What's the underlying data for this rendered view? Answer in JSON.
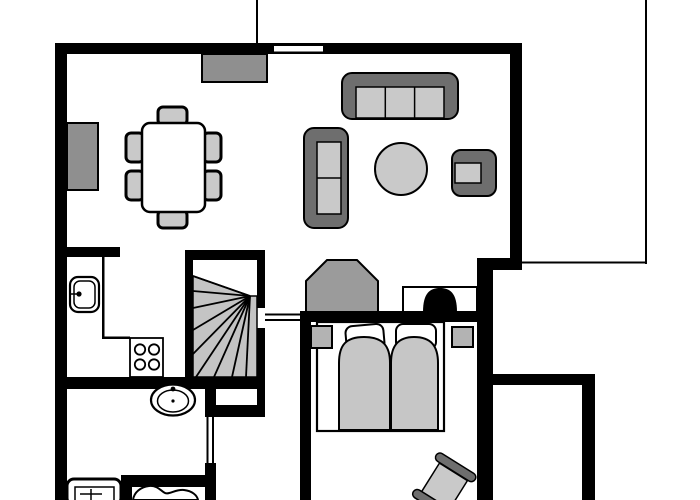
{
  "canvas": {
    "w": 700,
    "h": 500,
    "bg": "#ffffff"
  },
  "palette": {
    "ink": "#000000",
    "dark": "#6e6e6e",
    "mid": "#8f8f8f",
    "gray9b": "#9b9b9b",
    "light": "#c9c9c9",
    "bedgray": "#c6c6c6",
    "stair": "#c4c4c4",
    "nstand": "#b3b3b3",
    "white": "#ffffff"
  },
  "walls": [
    {
      "x": 55,
      "y": 43,
      "w": 467,
      "h": 11
    },
    {
      "x": 55,
      "y": 43,
      "w": 12,
      "h": 457
    },
    {
      "x": 510,
      "y": 43,
      "w": 12,
      "h": 222
    },
    {
      "x": 477,
      "y": 258,
      "w": 45,
      "h": 12
    },
    {
      "x": 477,
      "y": 258,
      "w": 16,
      "h": 242
    },
    {
      "x": 300,
      "y": 311,
      "w": 177,
      "h": 11
    },
    {
      "x": 300,
      "y": 311,
      "w": 11,
      "h": 189
    },
    {
      "x": 55,
      "y": 247,
      "w": 65,
      "h": 10
    },
    {
      "x": 185,
      "y": 250,
      "w": 80,
      "h": 10
    },
    {
      "x": 185,
      "y": 250,
      "w": 8,
      "h": 139
    },
    {
      "x": 257,
      "y": 250,
      "w": 8,
      "h": 58
    },
    {
      "x": 257,
      "y": 328,
      "w": 8,
      "h": 61
    },
    {
      "x": 55,
      "y": 377,
      "w": 210,
      "h": 12
    },
    {
      "x": 257,
      "y": 389,
      "w": 8,
      "h": 28
    },
    {
      "x": 205,
      "y": 405,
      "w": 60,
      "h": 12
    },
    {
      "x": 205,
      "y": 389,
      "w": 11,
      "h": 28
    },
    {
      "x": 205,
      "y": 463,
      "w": 11,
      "h": 37
    },
    {
      "x": 121,
      "y": 475,
      "w": 95,
      "h": 12
    },
    {
      "x": 121,
      "y": 475,
      "w": 11,
      "h": 25
    },
    {
      "x": 493,
      "y": 374,
      "w": 102,
      "h": 11
    },
    {
      "x": 582,
      "y": 374,
      "w": 13,
      "h": 126
    }
  ],
  "thin_lines": [
    {
      "x": 256,
      "y": 0,
      "w": 2,
      "h": 44
    },
    {
      "x": 645,
      "y": 0,
      "w": 2,
      "h": 264
    },
    {
      "x": 522,
      "y": 261.5,
      "w": 123,
      "h": 2
    },
    {
      "x": 102,
      "y": 257,
      "w": 2.5,
      "h": 81
    },
    {
      "x": 102,
      "y": 336.5,
      "w": 28,
      "h": 2.5
    }
  ],
  "openings": [
    {
      "name": "window-living-top",
      "rect": {
        "x": 274,
        "y": 46,
        "w": 49,
        "h": 5.5
      },
      "lines": []
    },
    {
      "name": "doorway-hall",
      "rect": {
        "x": 265,
        "y": 308,
        "w": 35,
        "h": 20
      },
      "lines": [
        {
          "x": 265,
          "y": 313.5,
          "w": 35,
          "h": 2
        },
        {
          "x": 265,
          "y": 319,
          "w": 35,
          "h": 2
        }
      ]
    },
    {
      "name": "doorway-bathroom",
      "rect": {
        "x": 205,
        "y": 417,
        "w": 11,
        "h": 46
      },
      "lines": [
        {
          "x": 206.5,
          "y": 417,
          "w": 2,
          "h": 46
        },
        {
          "x": 212,
          "y": 417,
          "w": 2,
          "h": 46
        }
      ]
    }
  ],
  "furniture": [
    {
      "name": "stairs",
      "shapes": [
        {
          "k": "poly",
          "pts": "193,276 250,296 257,296 257,377 193,377",
          "f": "stair",
          "s": "ink",
          "sw": 1.5
        },
        {
          "k": "line",
          "x1": 250,
          "y1": 296,
          "x2": 193,
          "y2": 276,
          "sw": 1.8
        },
        {
          "k": "line",
          "x1": 250,
          "y1": 296,
          "x2": 193,
          "y2": 291,
          "sw": 1.8
        },
        {
          "k": "line",
          "x1": 250,
          "y1": 296,
          "x2": 193,
          "y2": 308,
          "sw": 1.8
        },
        {
          "k": "line",
          "x1": 250,
          "y1": 296,
          "x2": 193,
          "y2": 330,
          "sw": 1.8
        },
        {
          "k": "line",
          "x1": 250,
          "y1": 296,
          "x2": 193,
          "y2": 354,
          "sw": 1.8
        },
        {
          "k": "line",
          "x1": 250,
          "y1": 296,
          "x2": 196,
          "y2": 377,
          "sw": 1.8
        },
        {
          "k": "line",
          "x1": 250,
          "y1": 296,
          "x2": 214,
          "y2": 377,
          "sw": 1.8
        },
        {
          "k": "line",
          "x1": 250,
          "y1": 296,
          "x2": 232,
          "y2": 377,
          "sw": 1.8
        },
        {
          "k": "line",
          "x1": 250,
          "y1": 296,
          "x2": 246,
          "y2": 377,
          "sw": 1.8
        }
      ]
    },
    {
      "name": "top-sideboard",
      "shapes": [
        {
          "k": "rect",
          "x": 202,
          "y": 54,
          "w": 65,
          "h": 28,
          "f": "mid",
          "s": "ink",
          "sw": 2
        }
      ]
    },
    {
      "name": "left-sideboard",
      "shapes": [
        {
          "k": "rect",
          "x": 67,
          "y": 123,
          "w": 31,
          "h": 67,
          "f": "mid",
          "s": "ink",
          "sw": 2
        }
      ]
    },
    {
      "name": "dining-set",
      "shapes": [
        {
          "k": "rect",
          "x": 158,
          "y": 107,
          "w": 29,
          "h": 18,
          "rx": 5,
          "f": "light",
          "s": "ink",
          "sw": 3
        },
        {
          "k": "rect",
          "x": 158,
          "y": 210,
          "w": 29,
          "h": 18,
          "rx": 5,
          "f": "light",
          "s": "ink",
          "sw": 3
        },
        {
          "k": "rect",
          "x": 126,
          "y": 133,
          "w": 18,
          "h": 29,
          "rx": 5,
          "f": "light",
          "s": "ink",
          "sw": 3
        },
        {
          "k": "rect",
          "x": 126,
          "y": 171,
          "w": 18,
          "h": 29,
          "rx": 5,
          "f": "light",
          "s": "ink",
          "sw": 3
        },
        {
          "k": "rect",
          "x": 203,
          "y": 133,
          "w": 18,
          "h": 29,
          "rx": 5,
          "f": "light",
          "s": "ink",
          "sw": 3
        },
        {
          "k": "rect",
          "x": 203,
          "y": 171,
          "w": 18,
          "h": 29,
          "rx": 5,
          "f": "light",
          "s": "ink",
          "sw": 3
        },
        {
          "k": "rect",
          "x": 142,
          "y": 123,
          "w": 63,
          "h": 89,
          "rx": 8,
          "f": "white",
          "s": "ink",
          "sw": 2.5
        }
      ]
    },
    {
      "name": "sofa-large",
      "shapes": [
        {
          "k": "rect",
          "x": 342,
          "y": 73,
          "w": 116,
          "h": 46,
          "rx": 10,
          "f": "dark",
          "s": "ink",
          "sw": 2
        },
        {
          "k": "rect",
          "x": 356,
          "y": 87,
          "w": 88,
          "h": 31,
          "f": "light",
          "s": "ink",
          "sw": 1.5
        },
        {
          "k": "line",
          "x1": 385.3,
          "y1": 87,
          "x2": 385.3,
          "y2": 118,
          "sw": 1.5
        },
        {
          "k": "line",
          "x1": 414.6,
          "y1": 87,
          "x2": 414.6,
          "y2": 118,
          "sw": 1.5
        }
      ]
    },
    {
      "name": "sofa-small",
      "shapes": [
        {
          "k": "rect",
          "x": 304,
          "y": 128,
          "w": 44,
          "h": 100,
          "rx": 10,
          "f": "dark",
          "s": "ink",
          "sw": 2
        },
        {
          "k": "rect",
          "x": 317,
          "y": 142,
          "w": 24,
          "h": 72,
          "f": "light",
          "s": "ink",
          "sw": 1.5
        },
        {
          "k": "line",
          "x1": 317,
          "y1": 178,
          "x2": 341,
          "y2": 178,
          "sw": 1.5
        }
      ]
    },
    {
      "name": "coffee-table",
      "shapes": [
        {
          "k": "circle",
          "cx": 401,
          "cy": 169,
          "r": 26,
          "f": "light",
          "s": "ink",
          "sw": 2
        }
      ]
    },
    {
      "name": "armchair",
      "shapes": [
        {
          "k": "rect",
          "x": 452,
          "y": 150,
          "w": 44,
          "h": 46,
          "rx": 9,
          "f": "dark",
          "s": "ink",
          "sw": 2
        },
        {
          "k": "rect",
          "x": 455,
          "y": 163,
          "w": 26,
          "h": 20,
          "f": "light",
          "s": "ink",
          "sw": 1.5
        }
      ]
    },
    {
      "name": "wardrobe",
      "shapes": [
        {
          "k": "poly",
          "pts": "306,281 327,260 357,260 378,281 378,312 306,312",
          "f": "gray9b",
          "s": "ink",
          "sw": 2
        }
      ]
    },
    {
      "name": "tv-cabinet",
      "shapes": [
        {
          "k": "rect",
          "x": 403,
          "y": 287,
          "w": 74,
          "h": 25,
          "f": "white",
          "s": "ink",
          "sw": 2
        },
        {
          "k": "path",
          "d": "M423,312 C423,293 430,288 440,288 C450,288 457,293 457,312 Z",
          "f": "ink"
        }
      ]
    },
    {
      "name": "double-bed",
      "shapes": [
        {
          "k": "rect",
          "x": 317,
          "y": 322,
          "w": 127,
          "h": 109,
          "f": "white",
          "s": "ink",
          "sw": 2.2
        },
        {
          "k": "rect",
          "x": 346,
          "y": 325,
          "w": 38,
          "h": 26,
          "rx": 7,
          "f": "white",
          "s": "ink",
          "sw": 2,
          "tf": "rotate(-5 365 338)"
        },
        {
          "k": "rect",
          "x": 396,
          "y": 324,
          "w": 40,
          "h": 25,
          "rx": 7,
          "f": "white",
          "s": "ink",
          "sw": 2
        },
        {
          "k": "path",
          "d": "M339,430 L339,363 C339,345 346,337 364,337 C383,337 390,346 390,363 L390,430 Z",
          "f": "bedgray",
          "s": "ink",
          "sw": 2
        },
        {
          "k": "path",
          "d": "M391,430 L391,363 C391,346 398,337 414,337 C431,337 438,346 438,363 L438,430 Z",
          "f": "bedgray",
          "s": "ink",
          "sw": 2
        }
      ]
    },
    {
      "name": "nightstand-left",
      "shapes": [
        {
          "k": "rect",
          "x": 311,
          "y": 326,
          "w": 21,
          "h": 22,
          "f": "nstand",
          "s": "ink",
          "sw": 2
        }
      ]
    },
    {
      "name": "nightstand-right",
      "shapes": [
        {
          "k": "rect",
          "x": 452,
          "y": 327,
          "w": 21,
          "h": 20,
          "f": "nstand",
          "s": "ink",
          "sw": 2
        }
      ]
    },
    {
      "name": "kitchen-sink",
      "shapes": [
        {
          "k": "rect",
          "x": 70,
          "y": 277,
          "w": 29,
          "h": 35,
          "rx": 8,
          "f": "white",
          "s": "ink",
          "sw": 2.2
        },
        {
          "k": "rect",
          "x": 74,
          "y": 281,
          "w": 21,
          "h": 27,
          "rx": 6,
          "f": "none",
          "s": "ink",
          "sw": 1.5
        },
        {
          "k": "line",
          "x1": 70,
          "y1": 294,
          "x2": 77,
          "y2": 294,
          "sw": 1.5
        },
        {
          "k": "circle",
          "cx": 79,
          "cy": 294,
          "r": 2.6,
          "f": "ink"
        }
      ]
    },
    {
      "name": "stove",
      "shapes": [
        {
          "k": "rect",
          "x": 130,
          "y": 338,
          "w": 33,
          "h": 39,
          "f": "white",
          "s": "ink",
          "sw": 1.8
        },
        {
          "k": "circle",
          "cx": 140,
          "cy": 349.5,
          "r": 5.2,
          "f": "white",
          "s": "ink",
          "sw": 1.8
        },
        {
          "k": "circle",
          "cx": 154,
          "cy": 349.5,
          "r": 5.2,
          "f": "white",
          "s": "ink",
          "sw": 1.8
        },
        {
          "k": "circle",
          "cx": 140,
          "cy": 364.5,
          "r": 5.2,
          "f": "white",
          "s": "ink",
          "sw": 1.8
        },
        {
          "k": "circle",
          "cx": 154,
          "cy": 364.5,
          "r": 5.2,
          "f": "white",
          "s": "ink",
          "sw": 1.8
        }
      ]
    },
    {
      "name": "bathroom-sink",
      "shapes": [
        {
          "k": "ellipse",
          "cx": 173,
          "cy": 400,
          "rx": 22,
          "ry": 15.5,
          "f": "white",
          "s": "ink",
          "sw": 2.2
        },
        {
          "k": "ellipse",
          "cx": 173,
          "cy": 401,
          "rx": 15.5,
          "ry": 11,
          "f": "none",
          "s": "ink",
          "sw": 1.5
        },
        {
          "k": "circle",
          "cx": 173,
          "cy": 389,
          "r": 2.4,
          "f": "ink"
        },
        {
          "k": "circle",
          "cx": 173,
          "cy": 401,
          "r": 1.6,
          "f": "ink"
        }
      ]
    },
    {
      "name": "washing-machine",
      "shapes": [
        {
          "k": "rect",
          "x": 67,
          "y": 479,
          "w": 54,
          "h": 26,
          "rx": 7,
          "f": "white",
          "s": "ink",
          "sw": 3
        },
        {
          "k": "rect",
          "x": 75,
          "y": 487,
          "w": 39,
          "h": 18,
          "f": "none",
          "s": "ink",
          "sw": 1.5
        },
        {
          "k": "line",
          "x1": 91,
          "y1": 489,
          "x2": 91,
          "y2": 500,
          "sw": 1.5
        },
        {
          "k": "line",
          "x1": 80,
          "y1": 494,
          "x2": 102,
          "y2": 494,
          "sw": 1.5
        }
      ]
    },
    {
      "name": "toilet",
      "shapes": [
        {
          "k": "path",
          "d": "M133,500 C134,492 141,487 149,486 C157,485 161,491 165,493 C169,495 176,489 184,490 C192,491 197,495 198,500 Z",
          "f": "white",
          "s": "ink",
          "sw": 2
        }
      ]
    },
    {
      "name": "cot",
      "shapes": [
        {
          "k": "rect",
          "x": 428,
          "y": 469,
          "w": 33,
          "h": 34,
          "f": "light",
          "s": "ink",
          "sw": 1.5,
          "tf": "rotate(32 444 486)"
        },
        {
          "k": "rect",
          "x": 421,
          "y": 459.5,
          "w": 46,
          "h": 9,
          "rx": 4.5,
          "f": "dark",
          "s": "ink",
          "sw": 1.5,
          "tf": "rotate(32 444 486)"
        },
        {
          "k": "rect",
          "x": 421,
          "y": 502.5,
          "w": 46,
          "h": 9,
          "rx": 4.5,
          "f": "dark",
          "s": "ink",
          "sw": 1.5,
          "tf": "rotate(32 444 486)"
        }
      ]
    }
  ]
}
